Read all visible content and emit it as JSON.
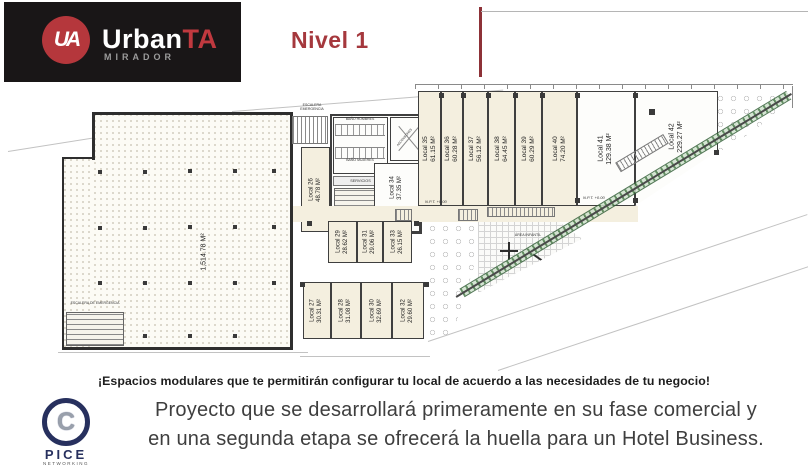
{
  "header": {
    "logo": {
      "monogram": "UA",
      "brand_primary": "Urban",
      "brand_accent": "TA",
      "subtitle": "MIRADOR"
    },
    "title": "Nivel 1"
  },
  "colors": {
    "accent_red": "#A5383D",
    "logo_red": "#B5373C",
    "navy": "#27305E"
  },
  "plan": {
    "area_label": "1,514.78 M²",
    "labels": {
      "stairs_top_1": "ESCALERA",
      "stairs_top_2": "EMERGENCIA",
      "emergency_stairs": "ESCALERA DE EMERGENCIA",
      "bath_men": "BAÑO HOMBRES",
      "bath_women": "BAÑO MUJERES",
      "services": "SERVICIOS",
      "elevators": "ASCENSORES",
      "playground": "ÁREA INFANTIL",
      "level_mark": "N.P.T. +0.00"
    },
    "locals": [
      {
        "name": "Local 26",
        "area": "48.78 M²"
      },
      {
        "name": "Local 27",
        "area": "30.31 M²"
      },
      {
        "name": "Local 28",
        "area": "31.08 M²"
      },
      {
        "name": "Local 29",
        "area": "28.62 M²"
      },
      {
        "name": "Local 30",
        "area": "32.69 M²"
      },
      {
        "name": "Local 31",
        "area": "29.06 M²"
      },
      {
        "name": "Local 32",
        "area": "29.60 M²"
      },
      {
        "name": "Local 33",
        "area": "26.15 M²"
      },
      {
        "name": "Local 34",
        "area": "37.35 M²"
      },
      {
        "name": "Local 35",
        "area": "61.15 M²"
      },
      {
        "name": "Local 36",
        "area": "60.28 M²"
      },
      {
        "name": "Local 37",
        "area": "56.12 M²"
      },
      {
        "name": "Local 38",
        "area": "64.45 M²"
      },
      {
        "name": "Local 39",
        "area": "60.29 M²"
      },
      {
        "name": "Local 40",
        "area": "74.20 M²"
      },
      {
        "name": "Local 41",
        "area": "129.38 M²"
      },
      {
        "name": "Local 42",
        "area": "229.27 M²"
      }
    ]
  },
  "footer": {
    "highlight": "¡Espacios modulares que te permitirán configurar tu local de acuerdo a las necesidades de tu negocio!",
    "body_line1": "Proyecto que se desarrollará primeramente en su fase comercial y",
    "body_line2": "en una segunda etapa se ofrecerá la huella para un Hotel Business.",
    "logo": {
      "initial": "C",
      "name": "PICE",
      "subtitle": "NETWORKING"
    }
  }
}
